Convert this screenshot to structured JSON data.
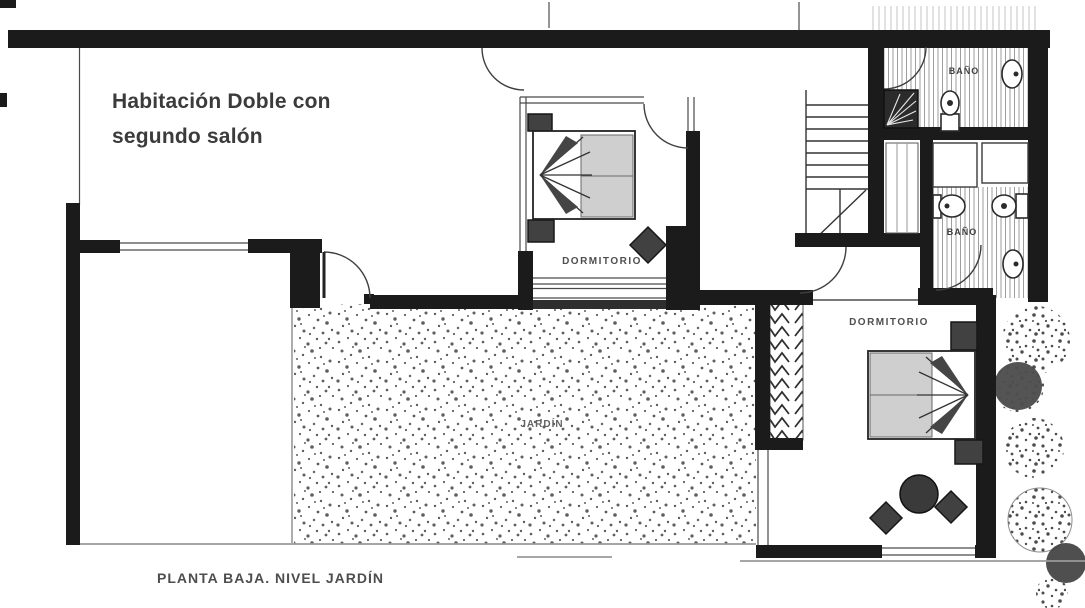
{
  "title": {
    "line1": "Habitación Doble con",
    "line2": "segundo salón"
  },
  "caption": "PLANTA BAJA. NIVEL JARDÍN",
  "rooms": {
    "bedroom1_label": "DORMITORIO",
    "bedroom2_label": "DORMITORIO",
    "bath1_label": "BAÑO",
    "bath2_label": "BAÑO",
    "garden_label": "JARDÍN"
  },
  "colors": {
    "wall": "#1b1b1b",
    "annotation_text": "#3b3b3b",
    "label_text": "#4f4f4f",
    "duvet_gray": "#cfcfcf",
    "furniture_gray": "#414141",
    "background": "#ffffff"
  }
}
